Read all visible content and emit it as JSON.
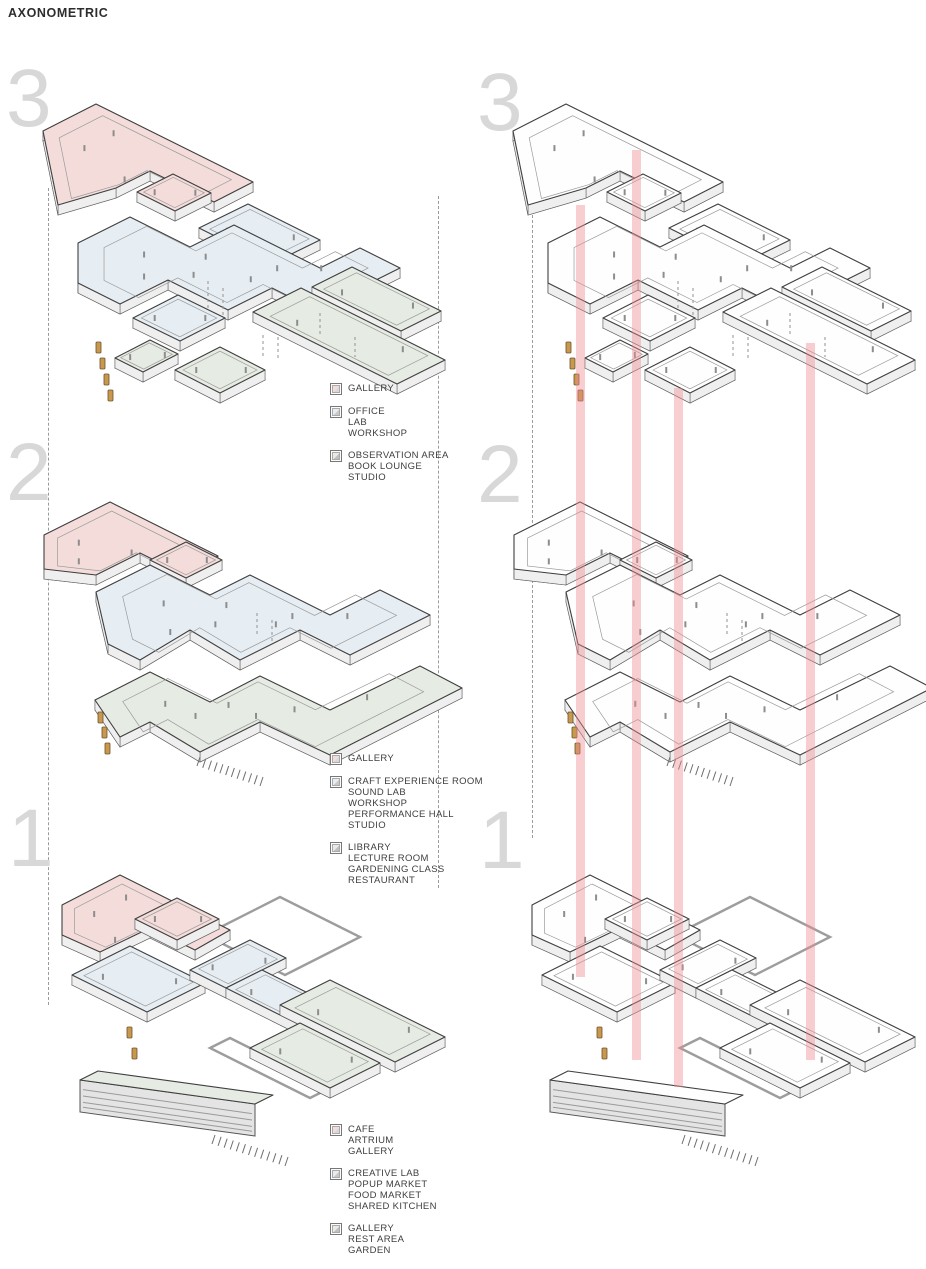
{
  "title": "AXONOMETRIC",
  "colors": {
    "pink": "#f3dcda",
    "blue": "#e7eef3",
    "green": "#e6ece3",
    "riser": "#ee8a90",
    "tan": "#c9984f",
    "numgray": "#d8d8d8"
  },
  "levels": [
    {
      "number": "3",
      "legend": [
        {
          "lines": [
            "GALLERY"
          ]
        },
        {
          "lines": [
            "OFFICE",
            "LAB",
            "WORKSHOP"
          ]
        },
        {
          "lines": [
            "OBSERVATION AREA",
            "BOOK LOUNGE",
            "STUDIO"
          ]
        }
      ]
    },
    {
      "number": "2",
      "legend": [
        {
          "lines": [
            "GALLERY"
          ]
        },
        {
          "lines": [
            "CRAFT EXPERIENCE ROOM",
            "SOUND LAB",
            "WORKSHOP",
            "PERFORMANCE HALL",
            "STUDIO"
          ]
        },
        {
          "lines": [
            "LIBRARY",
            "LECTURE ROOM",
            "GARDENING CLASS",
            "RESTAURANT"
          ]
        }
      ]
    },
    {
      "number": "1",
      "legend": [
        {
          "lines": [
            "CAFE",
            "ARTRIUM",
            "GALLERY"
          ]
        },
        {
          "lines": [
            "CREATIVE LAB",
            "POPUP MARKET",
            "FOOD MARKET",
            "SHARED KITCHEN"
          ]
        },
        {
          "lines": [
            "GALLERY",
            "REST AREA",
            "GARDEN"
          ]
        }
      ]
    }
  ]
}
